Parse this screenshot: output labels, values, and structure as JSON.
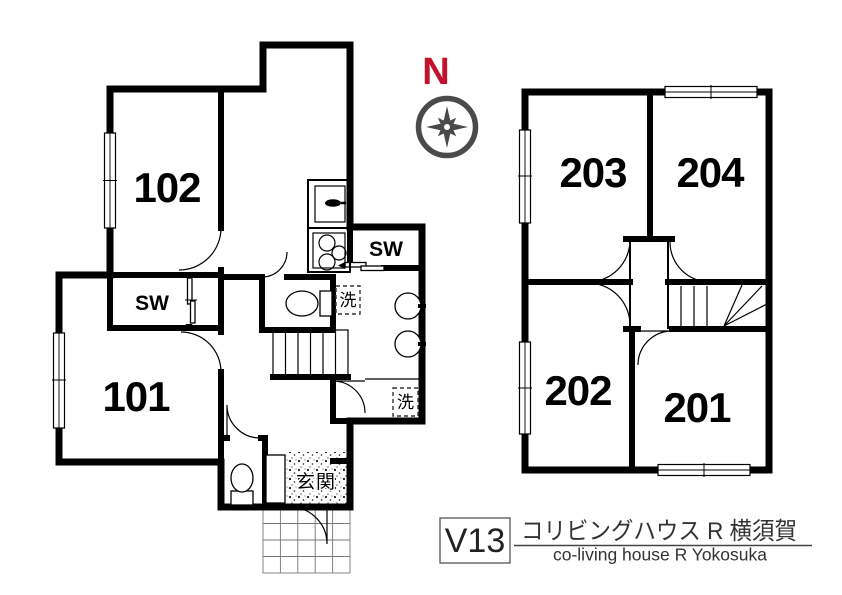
{
  "floor1": {
    "room_101_label": "101",
    "room_102_label": "102",
    "closet_left_label": "SW",
    "closet_kitchen_label": "SW",
    "laundry_mid_label": "洗",
    "laundry_lower_label": "洗",
    "entrance_label": "玄関"
  },
  "floor2": {
    "room_201_label": "201",
    "room_202_label": "202",
    "room_203_label": "203",
    "room_204_label": "204"
  },
  "compass": {
    "north_label": "N"
  },
  "title_block": {
    "plan_code": "V13",
    "name_ja": "コリビングハウス R 横須賀",
    "name_en": "co-living house R Yokosuka"
  },
  "colors": {
    "wall": "#000000",
    "north": "#c3122b",
    "compass_gray": "#4a4a4a",
    "title_text": "#333333"
  }
}
